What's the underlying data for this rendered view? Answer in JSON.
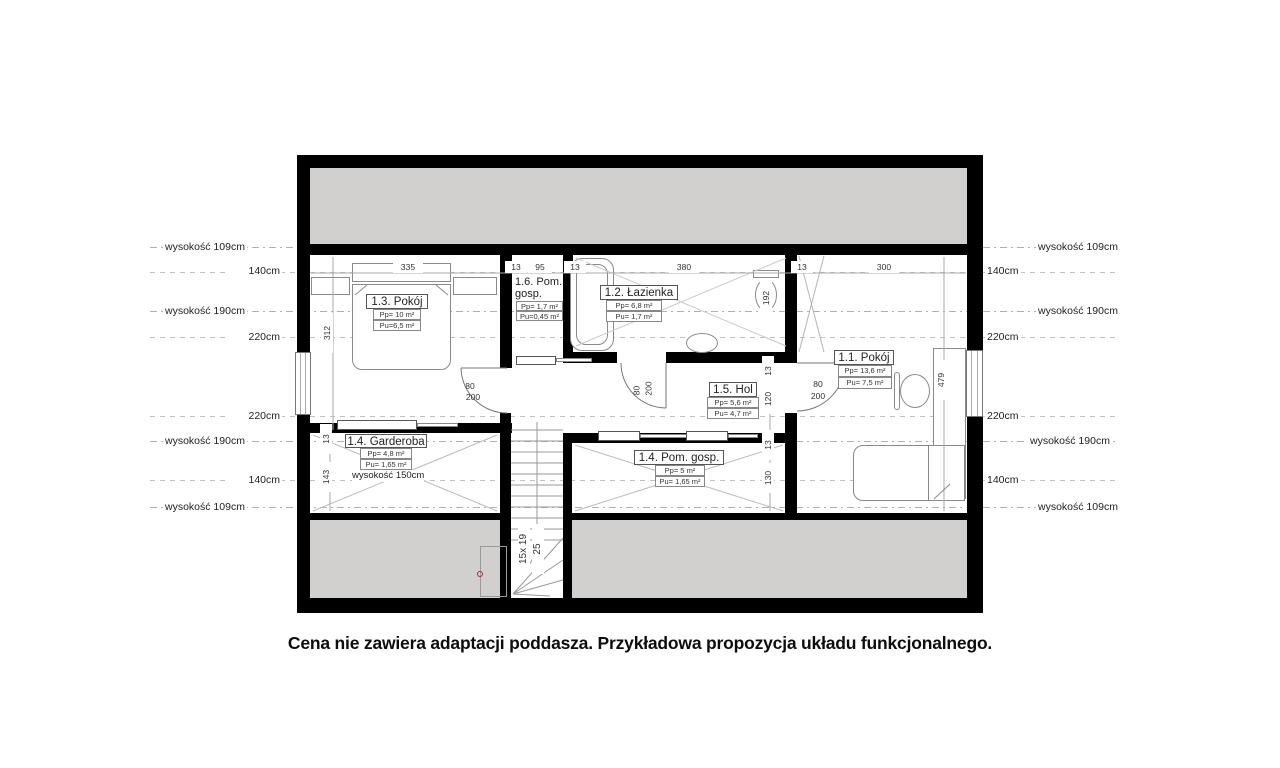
{
  "caption": "Cena nie zawiera adaptacji poddasza. Przykładowa propozycja układu funkcjonalnego.",
  "height_lines": [
    "wysokość 109cm",
    "140cm",
    "wysokość 190cm",
    "220cm",
    "220cm",
    "wysokość 190cm",
    "140cm",
    "wysokość 109cm"
  ],
  "dims": {
    "top": [
      "335",
      "13",
      "95",
      "13",
      "380",
      "13",
      "300"
    ],
    "v312": "312",
    "v192": "192",
    "v479": "479",
    "right_stack": [
      "13",
      "120",
      "13",
      "130"
    ],
    "left_stack": [
      "13",
      "143"
    ]
  },
  "door": {
    "width": "80",
    "height": "200"
  },
  "stairs": {
    "steps": "15x 19",
    "tread": "25"
  },
  "rooms": {
    "r13": {
      "name": "1.3. Pokój",
      "pp": "Pp= 10 m²",
      "pu": "Pu=6,5 m²"
    },
    "r16": {
      "name_l1": "1.6. Pom.",
      "name_l2": "gosp.",
      "pp": "Pp= 1,7 m²",
      "pu": "Pu=0,45 m²"
    },
    "r12": {
      "name": "1.2. Łazienka",
      "pp": "Pp= 6,8 m²",
      "pu": "Pu= 1,7 m²"
    },
    "r15": {
      "name": "1.5. Hol",
      "pp": "Pp= 5,6 m²",
      "pu": "Pu= 4,7 m²"
    },
    "r11": {
      "name": "1.1. Pokój",
      "pp": "Pp= 13,6 m²",
      "pu": "Pu= 7,5 m²"
    },
    "r14g": {
      "name": "1.4. Garderoba",
      "pp": "Pp= 4,8 m²",
      "pu": "Pu= 1,65 m²",
      "note": "wysokość 150cm"
    },
    "r14p": {
      "name": "1.4. Pom. gosp.",
      "pp": "Pp= 5 m²",
      "pu": "Pu= 1,65 m²"
    }
  },
  "colors": {
    "wall": "#000000",
    "roof_area": "#d2d0ce"
  }
}
